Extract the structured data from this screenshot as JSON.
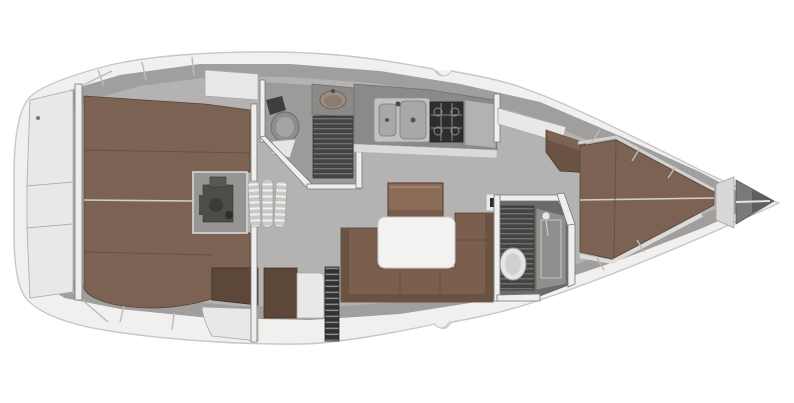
{
  "diagram": {
    "type": "yacht-interior-floorplan",
    "view": "top-down",
    "features": [
      "hull",
      "stern-transom-lockers",
      "aft-cabin-double-berth",
      "engine-compartment",
      "companionway-steps",
      "aft-head-toilet-sink-shower",
      "galley-double-sink-stove",
      "saloon-u-settee",
      "saloon-folding-table",
      "nav-area-cabinets",
      "forward-head-shower-toilet",
      "forward-cabin-v-berth",
      "bow-anchor-locker"
    ]
  },
  "colors": {
    "background": "#ffffff",
    "hull_outer": "#f1f0ee",
    "hull_edge": "#c8c7c5",
    "rim_dark": "#a09f9d",
    "floor": "#b5b3b1",
    "floor_shadow": "#9c9b99",
    "locker_white": "#e9e8e6",
    "wall_white": "#efeeec",
    "wall_edge": "#787776",
    "berth_brown": "#7c6253",
    "berth_brown_dark": "#5c4739",
    "berth_seam": "#55443a",
    "settee_brown": "#7a5f4f",
    "settee_back": "#6b5344",
    "cabinet_brown": "#8a6c59",
    "cabinet_brown_dark": "#5e4939",
    "table_white": "#f3f2f0",
    "counter_dark": "#8b8a88",
    "counter_edge": "#dadad8",
    "sink_basin": "#a9a8a6",
    "stove_dark": "#2f2e2d",
    "stove_grid": "#8d8c8a",
    "grate_dark": "#454442",
    "grate_line": "#71706e",
    "step_light": "#c9c8c6",
    "step_line": "#f2f1ef",
    "toilet_white": "#e6e5e3",
    "toilet_grey": "#8f8e8c",
    "engine_dark": "#4e4c49"
  }
}
